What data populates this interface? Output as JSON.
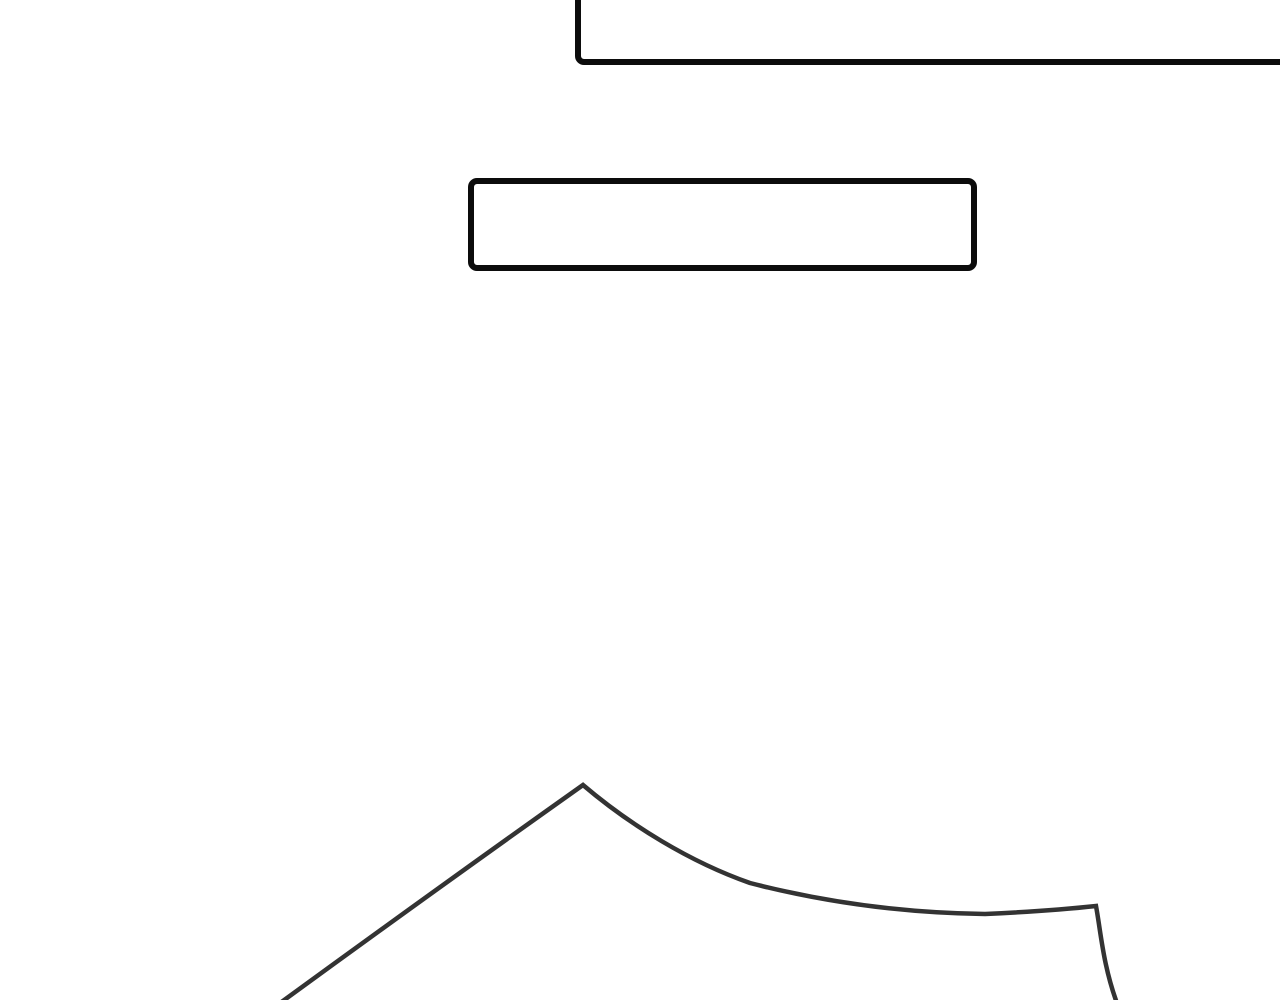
{
  "page": {
    "kind": "comic-page",
    "description": "Blank white comic page: two empty rectangular dialogue boxes and a partial line-art outline at the bottom"
  },
  "colors": {
    "page_background": "#ffffff",
    "panel_border": "#0c0c0c",
    "panel_fill": "#ffffff",
    "line_art": "#333333"
  },
  "panels": {
    "top": {
      "text": "",
      "state": "empty, cropped by top and right page edges"
    },
    "middle": {
      "text": "",
      "state": "empty"
    }
  },
  "artwork": {
    "name": "peaked-outline-drawing",
    "description": "Dark gray hand-drawn outline: long straight rise from bottom left to a sharp peak, concave slope easing right to a near-flat stretch, then a sharp corner dropping down past the bottom edge",
    "path": "M 276 1006 Q 435 890 583 785 C 630 825 690 862 750 883 C 820 901 900 913 985 914 Q 1050 911 1096 906 C 1101 933 1103 966 1118 1006"
  }
}
